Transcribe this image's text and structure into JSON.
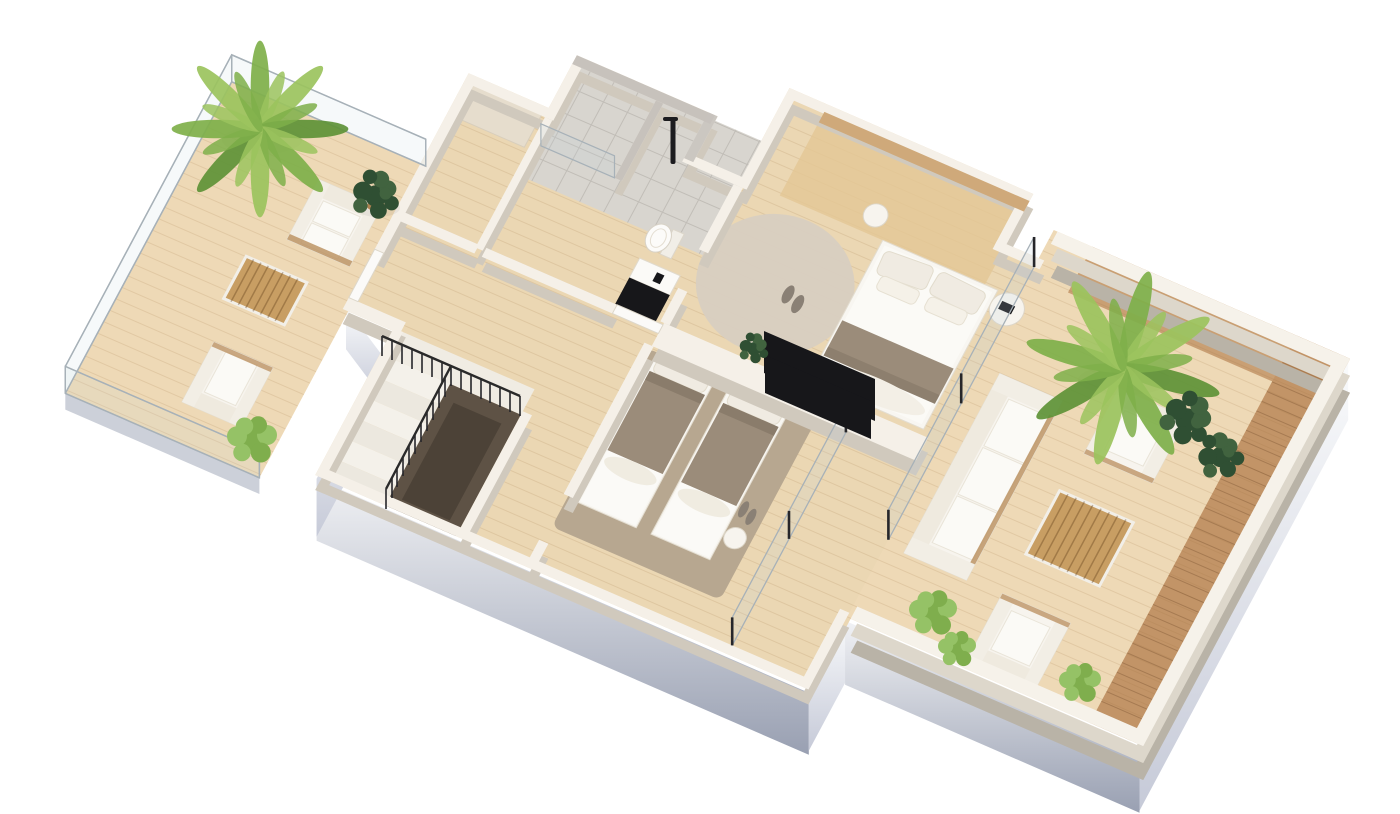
{
  "meta": {
    "type": "isometric-3d-floor-plan-rendering",
    "view": "axonometric top-down",
    "background": "#ffffff"
  },
  "colors": {
    "background": "#ffffff",
    "wall_top": "#f5f0e8",
    "wall_shadow": "#d0c9bd",
    "parapet_top": "#f6f2ea",
    "parapet_mid": "#ddd7cb",
    "parapet_deep": "#b9b3a7",
    "floor_wood": "#ebd7b3",
    "deck_light": "#eed9b6",
    "deck_dark": "#c29467",
    "tile_floor": "#d8d5cf",
    "tile_wall": "#c7c2bc",
    "headboard_wood": "#cfa97a",
    "master_platform": "#e4c795",
    "rug_master": "#d8cfc1",
    "rug_bedroom": "#b7a790",
    "blanket_taupe": "#9b8c7a",
    "duvet_white": "#fbfaf7",
    "pillow_cream": "#f0ebe2",
    "furniture_white": "#f7f4ee",
    "cushion_white": "#fbfaf6",
    "wicker_tan": "#b98e5c",
    "wood_table": "#c89e63",
    "stair_void": "#5e5245",
    "stair_tread_a": "#f4f1ea",
    "stair_tread_b": "#ece8df",
    "stair_landing": "#f0ece3",
    "fixture_black": "#17171a",
    "glass_frame": "#a7b1b8",
    "glass_post": "#26262a",
    "fascia_light": "#f1f2f5",
    "fascia_mid": "#c6cad8",
    "fascia_dark": "#99a0b2",
    "door_white": "#fbfaf8",
    "palm_light": "#9cc45e",
    "palm_mid": "#7fb04a",
    "palm_dark": "#5f9338",
    "ficus_dark": "#2f4f33",
    "ficus_light": "#41633f",
    "bush_green": "#7fae4d",
    "bush_light": "#95c266",
    "pot_tan": "#b08352",
    "shadow_soft": "#000000"
  },
  "areas": {
    "left_terrace": {
      "name": "open-terrace-with-glass-railing",
      "objects": [
        "palm-tree",
        "two-seat-outdoor-sofa",
        "slatted-coffee-table",
        "outdoor-armchair",
        "potted-ficus",
        "shrub"
      ]
    },
    "walk_in_closet": {
      "name": "walk-in-closet",
      "objects": [
        "wardrobe"
      ]
    },
    "bathroom": {
      "name": "bathroom",
      "objects": [
        "walk-in-shower",
        "shower-column",
        "glass-screen",
        "toilet",
        "black-vanity"
      ]
    },
    "master_bedroom": {
      "name": "master-bedroom",
      "objects": [
        "double-bed",
        "headboard-panel",
        "nightstand",
        "round-side-table",
        "round-rug",
        "slippers",
        "tv-panel",
        "potted-plant"
      ]
    },
    "hallway": {
      "name": "hallway",
      "objects": [
        "terrace-door"
      ]
    },
    "staircase": {
      "name": "staircase",
      "objects": [
        "steps",
        "black-balustrade",
        "stairwell-void"
      ]
    },
    "second_bedroom": {
      "name": "second-bedroom",
      "objects": [
        "single-bed",
        "single-bed",
        "rug",
        "stool",
        "slippers",
        "tv-panel",
        "glass-partition"
      ]
    },
    "right_terrace": {
      "name": "wrap-around-terrace-with-parapet",
      "objects": [
        "outdoor-sofa",
        "outdoor-armchair",
        "outdoor-armchair",
        "slatted-coffee-table",
        "palm-tree",
        "ficus-plants",
        "shrubs",
        "two-tone-decking"
      ]
    }
  }
}
